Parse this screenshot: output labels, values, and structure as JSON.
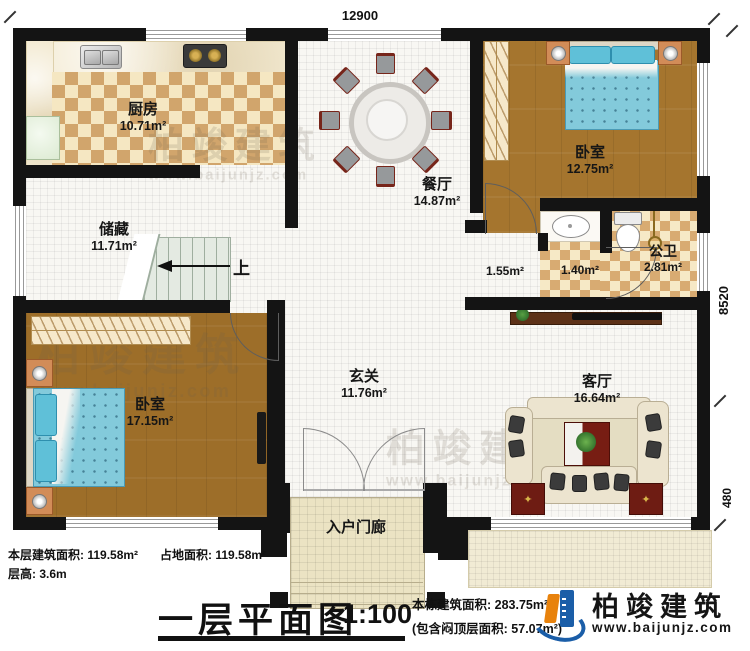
{
  "plan": {
    "dimensions": {
      "top_width": "12900",
      "right_height": "8520",
      "right_porch": "480"
    },
    "rooms": {
      "kitchen": {
        "name": "厨房",
        "area": "10.71m²"
      },
      "storage": {
        "name": "储藏",
        "area": "11.71m²"
      },
      "dining": {
        "name": "餐厅",
        "area": "14.87m²"
      },
      "bedroom_top": {
        "name": "卧室",
        "area": "12.75m²"
      },
      "hallway": {
        "area": "1.55m²"
      },
      "vanity": {
        "area": "1.40m²"
      },
      "bathroom": {
        "name": "公卫",
        "area": "2.81m²"
      },
      "foyer": {
        "name": "玄关",
        "area": "11.76m²"
      },
      "living": {
        "name": "客厅",
        "area": "16.64m²"
      },
      "bedroom_bottom": {
        "name": "卧室",
        "area": "17.15m²"
      },
      "porch": {
        "name": "入户门廊"
      }
    },
    "stairs": {
      "up_label": "上"
    }
  },
  "footer": {
    "floor_area": "本层建筑面积: 119.58m²",
    "ground_area": "占地面积: 119.58m²",
    "floor_height": "层高: 3.6m",
    "title": "一层平面图",
    "scale": "1:100",
    "building_area": "本栋建筑面积: 283.75m²",
    "attic_note": "(包含闷顶层面积: 57.07m²)"
  },
  "brand": {
    "name": "柏竣建筑",
    "url": "www.baijunjz.com"
  },
  "watermark": {
    "text": "柏竣建筑",
    "url": "www.baijunjz.com"
  },
  "icons": {
    "table_star": "✦"
  },
  "colors": {
    "wall": "#141414",
    "wood_floor": "#a5752e",
    "checker_dark": "#d1a56c",
    "checker_light": "#f5e7c2",
    "bed_blue": "#83cadb",
    "accent_red": "#6e1c13",
    "brand_blue": "#1b5ea8",
    "brand_orange": "#e8820c"
  }
}
